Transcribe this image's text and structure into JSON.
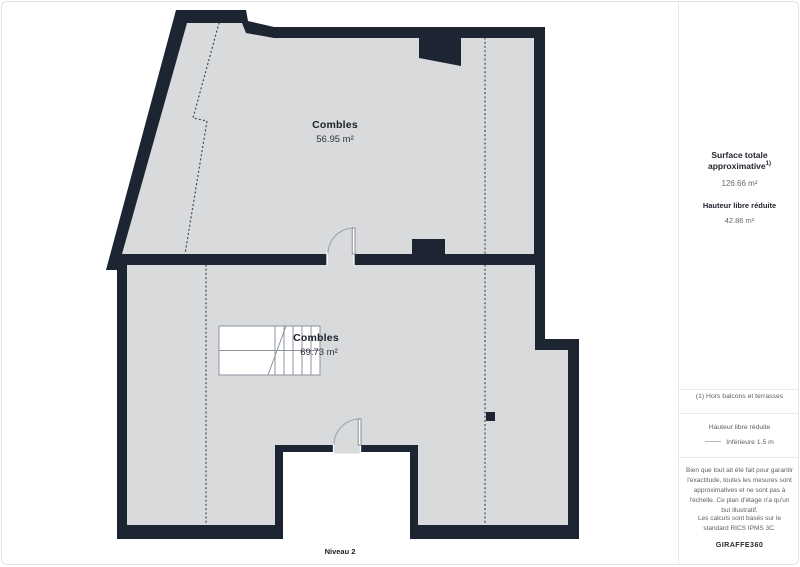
{
  "plan": {
    "rooms": [
      {
        "name": "Combles",
        "area": "56.95 m²"
      },
      {
        "name": "Combles",
        "area": "69.73 m²"
      }
    ],
    "level_label": "Niveau 2"
  },
  "sidebar": {
    "surface_title": "Surface totale approximative",
    "surface_title_sup": "1)",
    "surface_value": "126.66 m²",
    "height_title": "Hauteur libre réduite",
    "height_value": "42.86 m²",
    "note1": "(1) Hors balcons et terrasses",
    "legend_title": "Hauteur libre réduite",
    "legend_item": "Inférieure 1.5 m",
    "disclaimer": "Bien que tout ait été fait pour garantir l'exactitude, toutes les mesures sont approximatives et ne sont pas à l'échelle. Ce plan d'étage n'a qu'un but illustratif.",
    "standard_note": "Les calculs sont basés sur le standard RICS IPMS 3C.",
    "brand": "GIRAFFE360"
  },
  "colors": {
    "wall": "#1d2533",
    "floor": "#d9dadc",
    "reduced_height_line": "#3f4652",
    "divider": "#e8eaec"
  }
}
